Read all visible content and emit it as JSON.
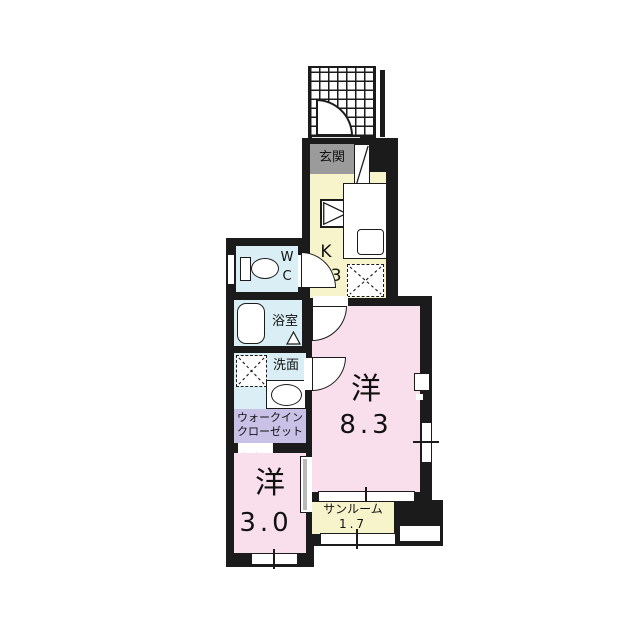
{
  "plan": {
    "type": "apartment-floor-plan",
    "colors": {
      "wall": "#1b1b1b",
      "western_room": "#f8dfeb",
      "kitchen_sunroom": "#f7f3cb",
      "wet_rooms": "#d9eef5",
      "closet": "#c9c2e6",
      "entrance": "#9b9b9b"
    },
    "rooms": {
      "genkan": {
        "label": "玄関"
      },
      "kitchen": {
        "label": "K",
        "size": "3.3"
      },
      "wc": {
        "line1": "W",
        "line2": "C"
      },
      "bathroom": {
        "label": "浴室"
      },
      "washroom": {
        "label": "洗面"
      },
      "walk_in_closet": {
        "line1": "ウォークイン",
        "line2": "クローゼット"
      },
      "western_large": {
        "label": "洋",
        "size": "8.3"
      },
      "western_small": {
        "label": "洋",
        "size": "3.0"
      },
      "sunroom": {
        "label": "サンルーム",
        "size": "1.7"
      }
    }
  }
}
